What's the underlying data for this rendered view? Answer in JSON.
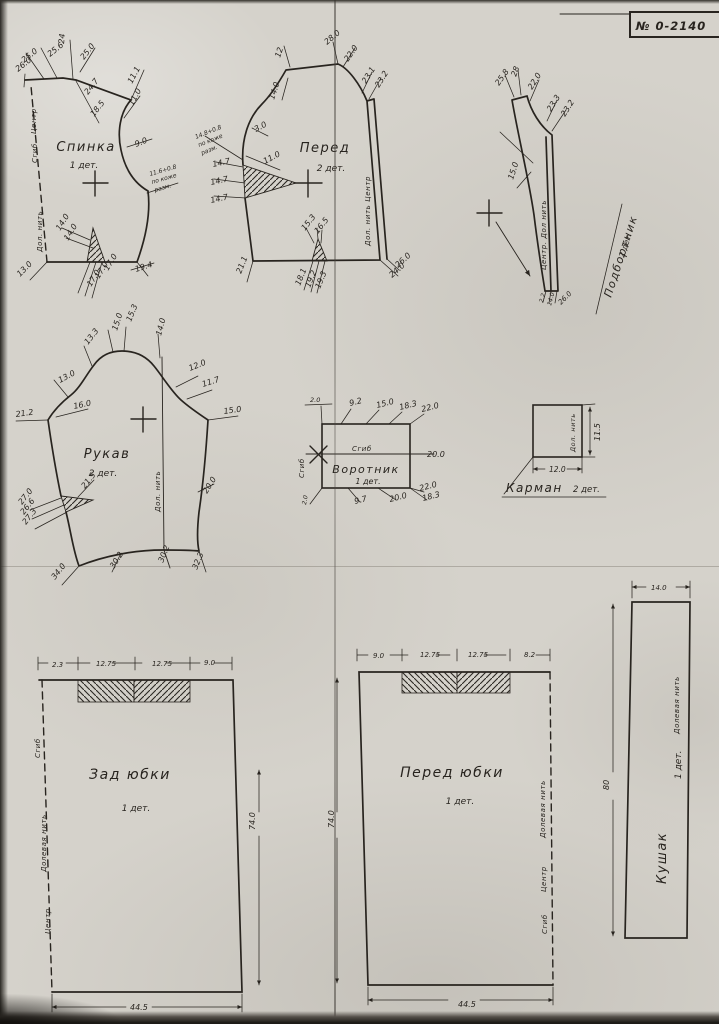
{
  "page": {
    "stamp": "№ 0-2140",
    "paper_color": "#d5d2cb",
    "ink_color": "#28241f"
  },
  "pieces": {
    "spinka": {
      "label": "Спинка",
      "qty": "1 дет.",
      "annotations": [
        {
          "t": "25.0",
          "x": 24,
          "y": 63,
          "r": -38
        },
        {
          "t": "26.0",
          "x": 18,
          "y": 72,
          "r": -38
        },
        {
          "t": "25.6",
          "x": 50,
          "y": 57,
          "r": -38
        },
        {
          "t": "24",
          "x": 64,
          "y": 44,
          "r": -85
        },
        {
          "t": "25.0",
          "x": 84,
          "y": 60,
          "r": -52
        },
        {
          "t": "24.7",
          "x": 88,
          "y": 95,
          "r": -52
        },
        {
          "t": "18.5",
          "x": 94,
          "y": 117,
          "r": -52
        },
        {
          "t": "11.1",
          "x": 132,
          "y": 84,
          "r": -62
        },
        {
          "t": "11.0",
          "x": 133,
          "y": 106,
          "r": -62
        },
        {
          "t": "9.0",
          "x": 136,
          "y": 147,
          "r": -22
        },
        {
          "t": "11.6+0.8",
          "x": 150,
          "y": 176,
          "r": -16,
          "fs": 6
        },
        {
          "t": "по коже",
          "x": 152,
          "y": 184,
          "r": -16,
          "fs": 6
        },
        {
          "t": "разм.",
          "x": 155,
          "y": 192,
          "r": -16,
          "fs": 6
        },
        {
          "t": "14.0",
          "x": 60,
          "y": 231,
          "r": -58
        },
        {
          "t": "14.0",
          "x": 68,
          "y": 241,
          "r": -58
        },
        {
          "t": "17.0",
          "x": 108,
          "y": 271,
          "r": -58
        },
        {
          "t": "17.0",
          "x": 99,
          "y": 279,
          "r": -58
        },
        {
          "t": "17.0",
          "x": 91,
          "y": 287,
          "r": -58
        },
        {
          "t": "13.0",
          "x": 20,
          "y": 277,
          "r": -45
        },
        {
          "t": "19.4",
          "x": 136,
          "y": 272,
          "r": -18
        },
        {
          "t": "Центр",
          "x": 36,
          "y": 134,
          "r": -90,
          "cls": "edge"
        },
        {
          "t": "Сгиб",
          "x": 37,
          "y": 163,
          "r": -90,
          "cls": "edge"
        },
        {
          "t": "Дол. нить",
          "x": 42,
          "y": 252,
          "r": -90,
          "cls": "edge"
        }
      ]
    },
    "pered": {
      "label": "Перед",
      "qty": "2 дет.",
      "annotations": [
        {
          "t": "28.0",
          "x": 327,
          "y": 45,
          "r": -40
        },
        {
          "t": "22.0",
          "x": 348,
          "y": 62,
          "r": -55
        },
        {
          "t": "12",
          "x": 280,
          "y": 58,
          "r": -72
        },
        {
          "t": "14.0",
          "x": 274,
          "y": 100,
          "r": -72
        },
        {
          "t": "3.0",
          "x": 256,
          "y": 132,
          "r": -28
        },
        {
          "t": "11.0",
          "x": 265,
          "y": 164,
          "r": -28
        },
        {
          "t": "23.1",
          "x": 366,
          "y": 84,
          "r": -58
        },
        {
          "t": "23.2",
          "x": 379,
          "y": 88,
          "r": -58
        },
        {
          "t": "14.8+0.8",
          "x": 196,
          "y": 139,
          "r": -22,
          "fs": 6
        },
        {
          "t": "по коже",
          "x": 199,
          "y": 147,
          "r": -22,
          "fs": 6
        },
        {
          "t": "разм.",
          "x": 202,
          "y": 155,
          "r": -22,
          "fs": 6
        },
        {
          "t": "14.7",
          "x": 213,
          "y": 167,
          "r": -12
        },
        {
          "t": "14.7",
          "x": 211,
          "y": 185,
          "r": -12
        },
        {
          "t": "14.7",
          "x": 211,
          "y": 203,
          "r": -12
        },
        {
          "t": "21.1",
          "x": 241,
          "y": 274,
          "r": -68
        },
        {
          "t": "15.3",
          "x": 305,
          "y": 231,
          "r": -52
        },
        {
          "t": "16.5",
          "x": 318,
          "y": 234,
          "r": -52
        },
        {
          "t": "18.1",
          "x": 300,
          "y": 286,
          "r": -68
        },
        {
          "t": "19.2",
          "x": 310,
          "y": 288,
          "r": -68
        },
        {
          "t": "19.3",
          "x": 320,
          "y": 289,
          "r": -68
        },
        {
          "t": "26.0",
          "x": 398,
          "y": 268,
          "r": -42
        },
        {
          "t": "24.0",
          "x": 392,
          "y": 278,
          "r": -42
        },
        {
          "t": "Дол. нить  Центр",
          "x": 370,
          "y": 246,
          "r": -90,
          "cls": "edge"
        }
      ]
    },
    "podbortnik": {
      "label": "Подбортник",
      "qty": "2 дет.",
      "annotations": [
        {
          "t": "25.8",
          "x": 499,
          "y": 86,
          "r": -55
        },
        {
          "t": "28",
          "x": 516,
          "y": 77,
          "r": -70
        },
        {
          "t": "22.0",
          "x": 532,
          "y": 90,
          "r": -58
        },
        {
          "t": "23.3",
          "x": 551,
          "y": 112,
          "r": -58
        },
        {
          "t": "23.2",
          "x": 565,
          "y": 117,
          "r": -58
        },
        {
          "t": "15.0",
          "x": 513,
          "y": 180,
          "r": -72
        },
        {
          "t": "Центр.  Дол нить",
          "x": 546,
          "y": 270,
          "r": -90,
          "cls": "edge"
        },
        {
          "t": "2.2",
          "x": 543,
          "y": 303,
          "r": -75,
          "fs": 6
        },
        {
          "t": "14.0",
          "x": 551,
          "y": 306,
          "r": -75,
          "fs": 6
        },
        {
          "t": "26.0",
          "x": 561,
          "y": 305,
          "r": -45,
          "fs": 7
        }
      ]
    },
    "rukav": {
      "label": "Рукав",
      "qty": "2 дет.",
      "annotations": [
        {
          "t": "21.2",
          "x": 16,
          "y": 417,
          "r": -8
        },
        {
          "t": "16.0",
          "x": 74,
          "y": 409,
          "r": -12
        },
        {
          "t": "13.0",
          "x": 60,
          "y": 383,
          "r": -28
        },
        {
          "t": "13.3",
          "x": 88,
          "y": 345,
          "r": -52
        },
        {
          "t": "15.0",
          "x": 117,
          "y": 331,
          "r": -72
        },
        {
          "t": "15.3",
          "x": 131,
          "y": 322,
          "r": -68
        },
        {
          "t": "14.0",
          "x": 161,
          "y": 336,
          "r": -75
        },
        {
          "t": "12.0",
          "x": 190,
          "y": 371,
          "r": -22
        },
        {
          "t": "11.7",
          "x": 203,
          "y": 387,
          "r": -18
        },
        {
          "t": "15.0",
          "x": 224,
          "y": 414,
          "r": -8
        },
        {
          "t": "21.5",
          "x": 85,
          "y": 489,
          "r": -52
        },
        {
          "t": "27.0",
          "x": 22,
          "y": 505,
          "r": -52
        },
        {
          "t": "26.6",
          "x": 24,
          "y": 515,
          "r": -52
        },
        {
          "t": "27.3",
          "x": 26,
          "y": 525,
          "r": -52
        },
        {
          "t": "34.0",
          "x": 55,
          "y": 580,
          "r": -52
        },
        {
          "t": "30.2",
          "x": 114,
          "y": 569,
          "r": -58
        },
        {
          "t": "30.2",
          "x": 163,
          "y": 563,
          "r": -68
        },
        {
          "t": "32.3",
          "x": 197,
          "y": 570,
          "r": -68
        },
        {
          "t": "20.0",
          "x": 207,
          "y": 494,
          "r": -58
        },
        {
          "t": "Дол. нить",
          "x": 160,
          "y": 512,
          "r": -90,
          "cls": "edge"
        }
      ]
    },
    "vorotnik": {
      "label": "Воротник",
      "qty": "1 дет.",
      "annotations": [
        {
          "t": "2.0",
          "x": 310,
          "y": 402,
          "r": 0,
          "fs": 6.5
        },
        {
          "t": "9.2",
          "x": 350,
          "y": 406,
          "r": -14
        },
        {
          "t": "15.0",
          "x": 377,
          "y": 408,
          "r": -14
        },
        {
          "t": "18.3",
          "x": 400,
          "y": 410,
          "r": -14
        },
        {
          "t": "22.0",
          "x": 422,
          "y": 412,
          "r": -14
        },
        {
          "t": "Сгиб",
          "x": 352,
          "y": 451,
          "r": 0,
          "cls": "edge"
        },
        {
          "t": "20.0",
          "x": 427,
          "y": 457,
          "r": 0
        },
        {
          "t": "Сгиб",
          "x": 304,
          "y": 478,
          "r": -90,
          "cls": "edge"
        },
        {
          "t": "2.0",
          "x": 306,
          "y": 505,
          "r": -80,
          "fs": 6
        },
        {
          "t": "9.7",
          "x": 355,
          "y": 504,
          "r": -14
        },
        {
          "t": "20.0",
          "x": 390,
          "y": 502,
          "r": -14
        },
        {
          "t": "22.0",
          "x": 420,
          "y": 491,
          "r": -14
        },
        {
          "t": "18.3",
          "x": 423,
          "y": 501,
          "r": -14
        }
      ]
    },
    "karman": {
      "label": "Карман",
      "qty": "2 дет.",
      "annotations": [
        {
          "t": "Дол. нить",
          "x": 575,
          "y": 452,
          "r": -90,
          "cls": "edge",
          "fs": 6.5
        },
        {
          "t": "11.5",
          "x": 600,
          "y": 441,
          "r": -90
        },
        {
          "t": "12.0",
          "x": 549,
          "y": 472,
          "r": 0,
          "fs": 7.5
        }
      ]
    },
    "zad_yubki": {
      "label": "Зад юбки",
      "qty": "1 дет.",
      "annotations": [
        {
          "t": "2.3",
          "x": 52,
          "y": 667,
          "r": 0,
          "fs": 7
        },
        {
          "t": "12.75",
          "x": 96,
          "y": 666,
          "r": 0,
          "fs": 7
        },
        {
          "t": "12.75",
          "x": 152,
          "y": 666,
          "r": 0,
          "fs": 7
        },
        {
          "t": "9.0",
          "x": 204,
          "y": 665,
          "r": 0,
          "fs": 7
        },
        {
          "t": "74.0",
          "x": 255,
          "y": 830,
          "r": -90
        },
        {
          "t": "44.5",
          "x": 130,
          "y": 1010,
          "r": 0
        },
        {
          "t": "Сгиб",
          "x": 40,
          "y": 758,
          "r": -90,
          "cls": "edge"
        },
        {
          "t": "Долевая нить",
          "x": 46,
          "y": 872,
          "r": -90,
          "cls": "edge"
        },
        {
          "t": "Центр",
          "x": 50,
          "y": 934,
          "r": -90,
          "cls": "edge"
        }
      ]
    },
    "pered_yubki": {
      "label": "Перед юбки",
      "qty": "1 дет.",
      "annotations": [
        {
          "t": "9.0",
          "x": 373,
          "y": 658,
          "r": 0,
          "fs": 7
        },
        {
          "t": "12.75",
          "x": 420,
          "y": 657,
          "r": 0,
          "fs": 7
        },
        {
          "t": "12.75",
          "x": 468,
          "y": 657,
          "r": 0,
          "fs": 7
        },
        {
          "t": "8.2",
          "x": 524,
          "y": 657,
          "r": 0,
          "fs": 7
        },
        {
          "t": "74.0",
          "x": 334,
          "y": 828,
          "r": -90
        },
        {
          "t": "44.5",
          "x": 458,
          "y": 1007,
          "r": 0
        },
        {
          "t": "Сгиб",
          "x": 547,
          "y": 934,
          "r": -90,
          "cls": "edge"
        },
        {
          "t": "Центр",
          "x": 546,
          "y": 892,
          "r": -90,
          "cls": "edge"
        },
        {
          "t": "Долевая нить",
          "x": 545,
          "y": 838,
          "r": -90,
          "cls": "edge"
        }
      ]
    },
    "kushak": {
      "label": "Кушак",
      "qty": "1 дет.",
      "annotations": [
        {
          "t": "14.0",
          "x": 651,
          "y": 590,
          "r": 0,
          "fs": 7
        },
        {
          "t": "80",
          "x": 609,
          "y": 790,
          "r": -90
        },
        {
          "t": "Долевая нить",
          "x": 679,
          "y": 734,
          "r": -90,
          "cls": "edge"
        }
      ]
    }
  }
}
